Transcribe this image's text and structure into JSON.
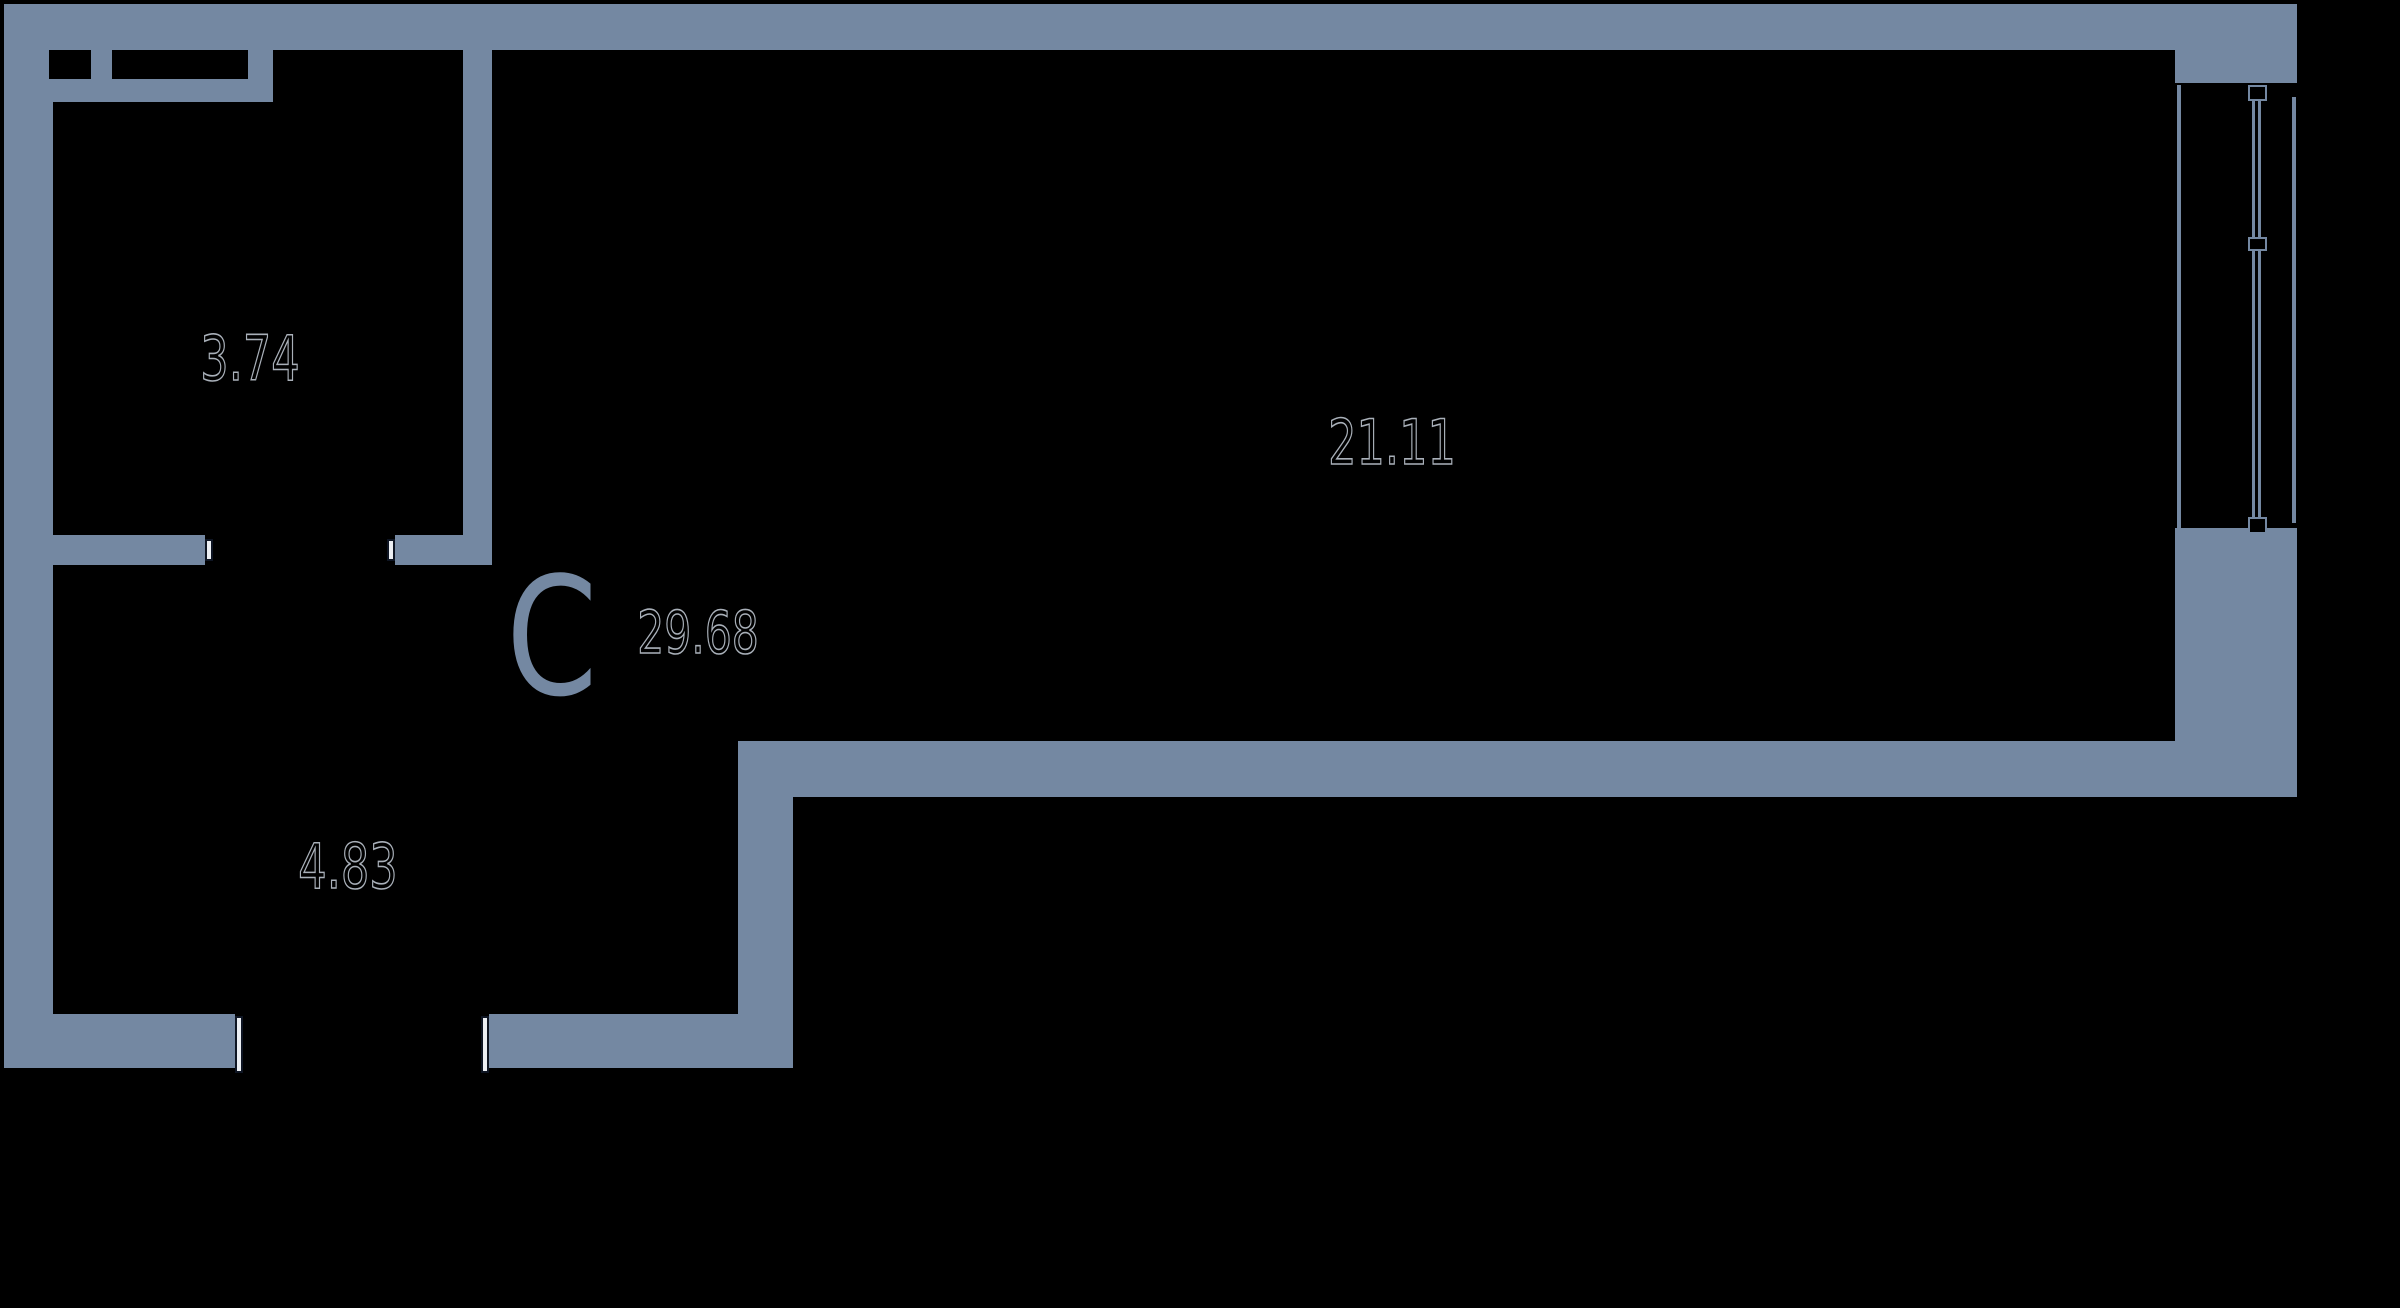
{
  "plan": {
    "studio_letter": "С",
    "total_area": "29.68",
    "rooms": [
      {
        "id": "room-top-left",
        "area": "3.74"
      },
      {
        "id": "room-right",
        "area": "21.11"
      },
      {
        "id": "room-bottom-left",
        "area": "4.83"
      }
    ],
    "colors": {
      "wall": "#7488A2",
      "background": "#000000",
      "number_outline": "#A9B0B9",
      "jamb_fill": "#ECEFF3",
      "jamb_border": "#0E1523"
    }
  }
}
